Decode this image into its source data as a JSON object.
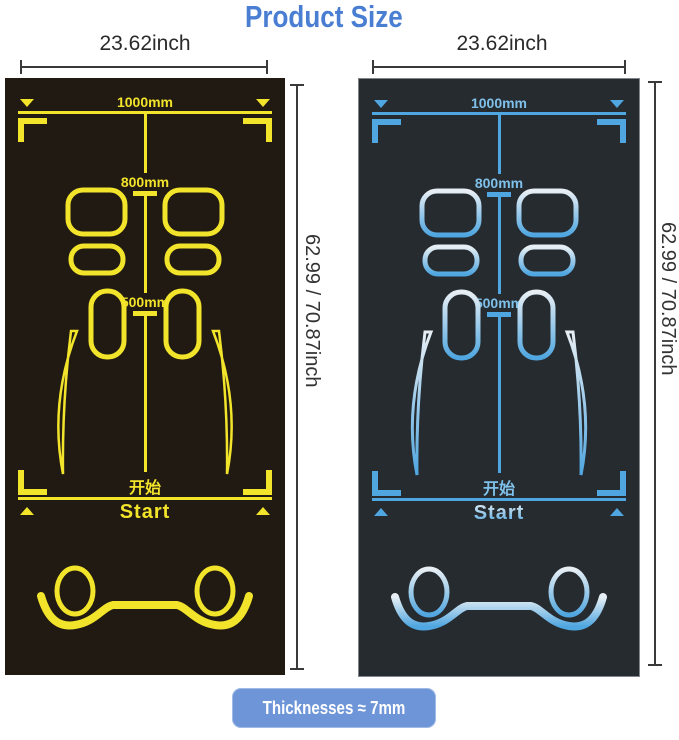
{
  "title": "Product Size",
  "colors": {
    "title-color": "#4a7ed2",
    "dim-color": "#3a3a3a",
    "left-bg": "#211a12",
    "left-accent": "#f2e42a",
    "right-bg": "#262b30",
    "right-accent": "#4fa6e0",
    "right-accent-light": "#e8eff4",
    "right-text": "#7fc0ea",
    "button-bg": "#6d95d8",
    "button-text": "#ffffff"
  },
  "mats": [
    {
      "variant": "yellow-on-black",
      "width_label": "23.62inch",
      "height_label": "62.99 / 70.87inch",
      "length_top": "1000mm",
      "length_mid": "800mm",
      "length_low": "500mm",
      "start_cn": "开始",
      "start_en": "Start"
    },
    {
      "variant": "blue-on-dark",
      "width_label": "23.62inch",
      "height_label": "62.99 / 70.87inch",
      "length_top": "1000mm",
      "length_mid": "800mm",
      "length_low": "500mm",
      "start_cn": "开始",
      "start_en": "Start"
    }
  ],
  "footer": {
    "thickness_label": "Thicknesses ≈ 7mm"
  }
}
